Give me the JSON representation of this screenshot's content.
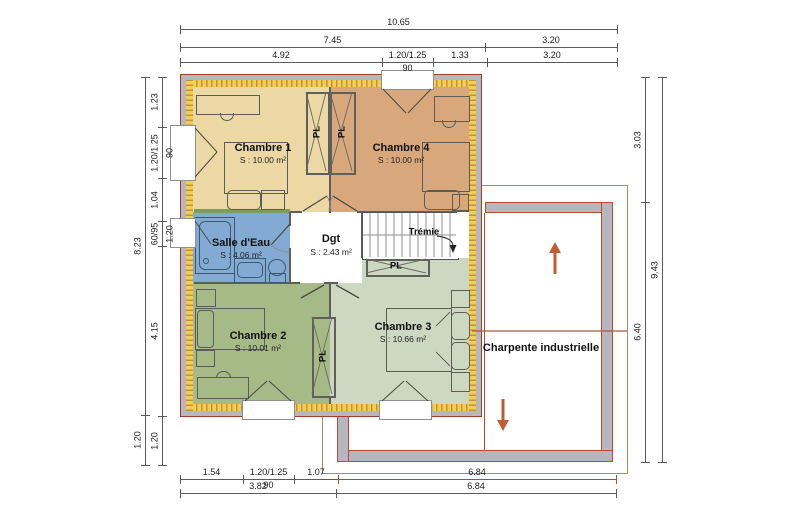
{
  "plan": {
    "rooms": [
      {
        "id": "chambre1",
        "name": "Chambre 1",
        "area": "S : 10.00 m²",
        "color": "#ecd8a4"
      },
      {
        "id": "chambre4",
        "name": "Chambre 4",
        "area": "S : 10.00 m²",
        "color": "#d8a87c"
      },
      {
        "id": "salle_eau",
        "name": "Salle d'Eau",
        "area": "S : 4.06 m²",
        "color": "#82aad2"
      },
      {
        "id": "dgt",
        "name": "Dgt",
        "area": "S : 2.43 m²",
        "color": "#ffffff"
      },
      {
        "id": "chambre2",
        "name": "Chambre 2",
        "area": "S : 10.01 m²",
        "color": "#a6ba88"
      },
      {
        "id": "chambre3",
        "name": "Chambre 3",
        "area": "S : 10.66 m²",
        "color": "#cdd8c2"
      }
    ],
    "labels": {
      "tremie": "Trémie",
      "charpente": "Charpente industrielle",
      "closet": "PL"
    },
    "colors": {
      "wall_gray": "#b7b7bf",
      "wall_outline_red": "#a33d2a",
      "hatch_yellow": "#f0cf57",
      "hatch_orange": "#cd8f35",
      "garage_outline_brown": "#b8885a",
      "garage_wall_red": "#bf4a30",
      "ridge_brown": "#a85a38",
      "arrow_orange": "#bf5c32",
      "dim_default": "#5a5a5a",
      "dim_brown": "#a0522d"
    }
  },
  "dimensions": {
    "horizontal": [
      {
        "y": 29,
        "segments": [
          {
            "from": 180,
            "to": 617,
            "label": "10.65"
          }
        ]
      },
      {
        "y": 47,
        "segments": [
          {
            "from": 180,
            "to": 485,
            "label": "7.45"
          },
          {
            "from": 485,
            "to": 617,
            "label": "3.20"
          }
        ]
      },
      {
        "y": 62,
        "segments": [
          {
            "from": 180,
            "to": 382,
            "label": "4.92"
          },
          {
            "from": 382,
            "to": 433,
            "label": "1.20/1.25",
            "sub": "90"
          },
          {
            "from": 433,
            "to": 487,
            "label": "1.33"
          },
          {
            "from": 487,
            "to": 617,
            "label": "3.20"
          }
        ]
      },
      {
        "y": 479,
        "segments": [
          {
            "from": 180,
            "to": 243,
            "label": "1.54"
          },
          {
            "from": 243,
            "to": 294,
            "label": "1.20/1.25",
            "sub": "90"
          },
          {
            "from": 294,
            "to": 338,
            "label": "1.07"
          }
        ]
      },
      {
        "y": 479,
        "color": "#a0522d",
        "segments": [
          {
            "from": 338,
            "to": 616,
            "label": "6.84"
          }
        ]
      },
      {
        "y": 493,
        "segments": [
          {
            "from": 180,
            "to": 336,
            "label": "3.82"
          },
          {
            "from": 336,
            "to": 616,
            "label": "6.84"
          }
        ]
      }
    ],
    "vertical": [
      {
        "x": 145,
        "segments": [
          {
            "from": 77,
            "to": 415,
            "label": "8.23"
          },
          {
            "from": 415,
            "to": 465,
            "label": "1.20"
          }
        ]
      },
      {
        "x": 162,
        "segments": [
          {
            "from": 77,
            "to": 127,
            "label": "1.23"
          },
          {
            "from": 127,
            "to": 178,
            "label": "1.20/1.25",
            "sub": "90"
          },
          {
            "from": 178,
            "to": 221,
            "label": "1.04"
          },
          {
            "from": 221,
            "to": 246,
            "label": "60/95",
            "sub": "1.20"
          },
          {
            "from": 246,
            "to": 416,
            "label": "4.15"
          },
          {
            "from": 416,
            "to": 465,
            "label": "1.20"
          }
        ]
      },
      {
        "x": 645,
        "segments": [
          {
            "from": 77,
            "to": 202,
            "label": "3.03"
          },
          {
            "from": 202,
            "to": 462,
            "label": "6.40"
          }
        ]
      },
      {
        "x": 662,
        "segments": [
          {
            "from": 77,
            "to": 462,
            "label": "9.43"
          }
        ]
      }
    ]
  }
}
